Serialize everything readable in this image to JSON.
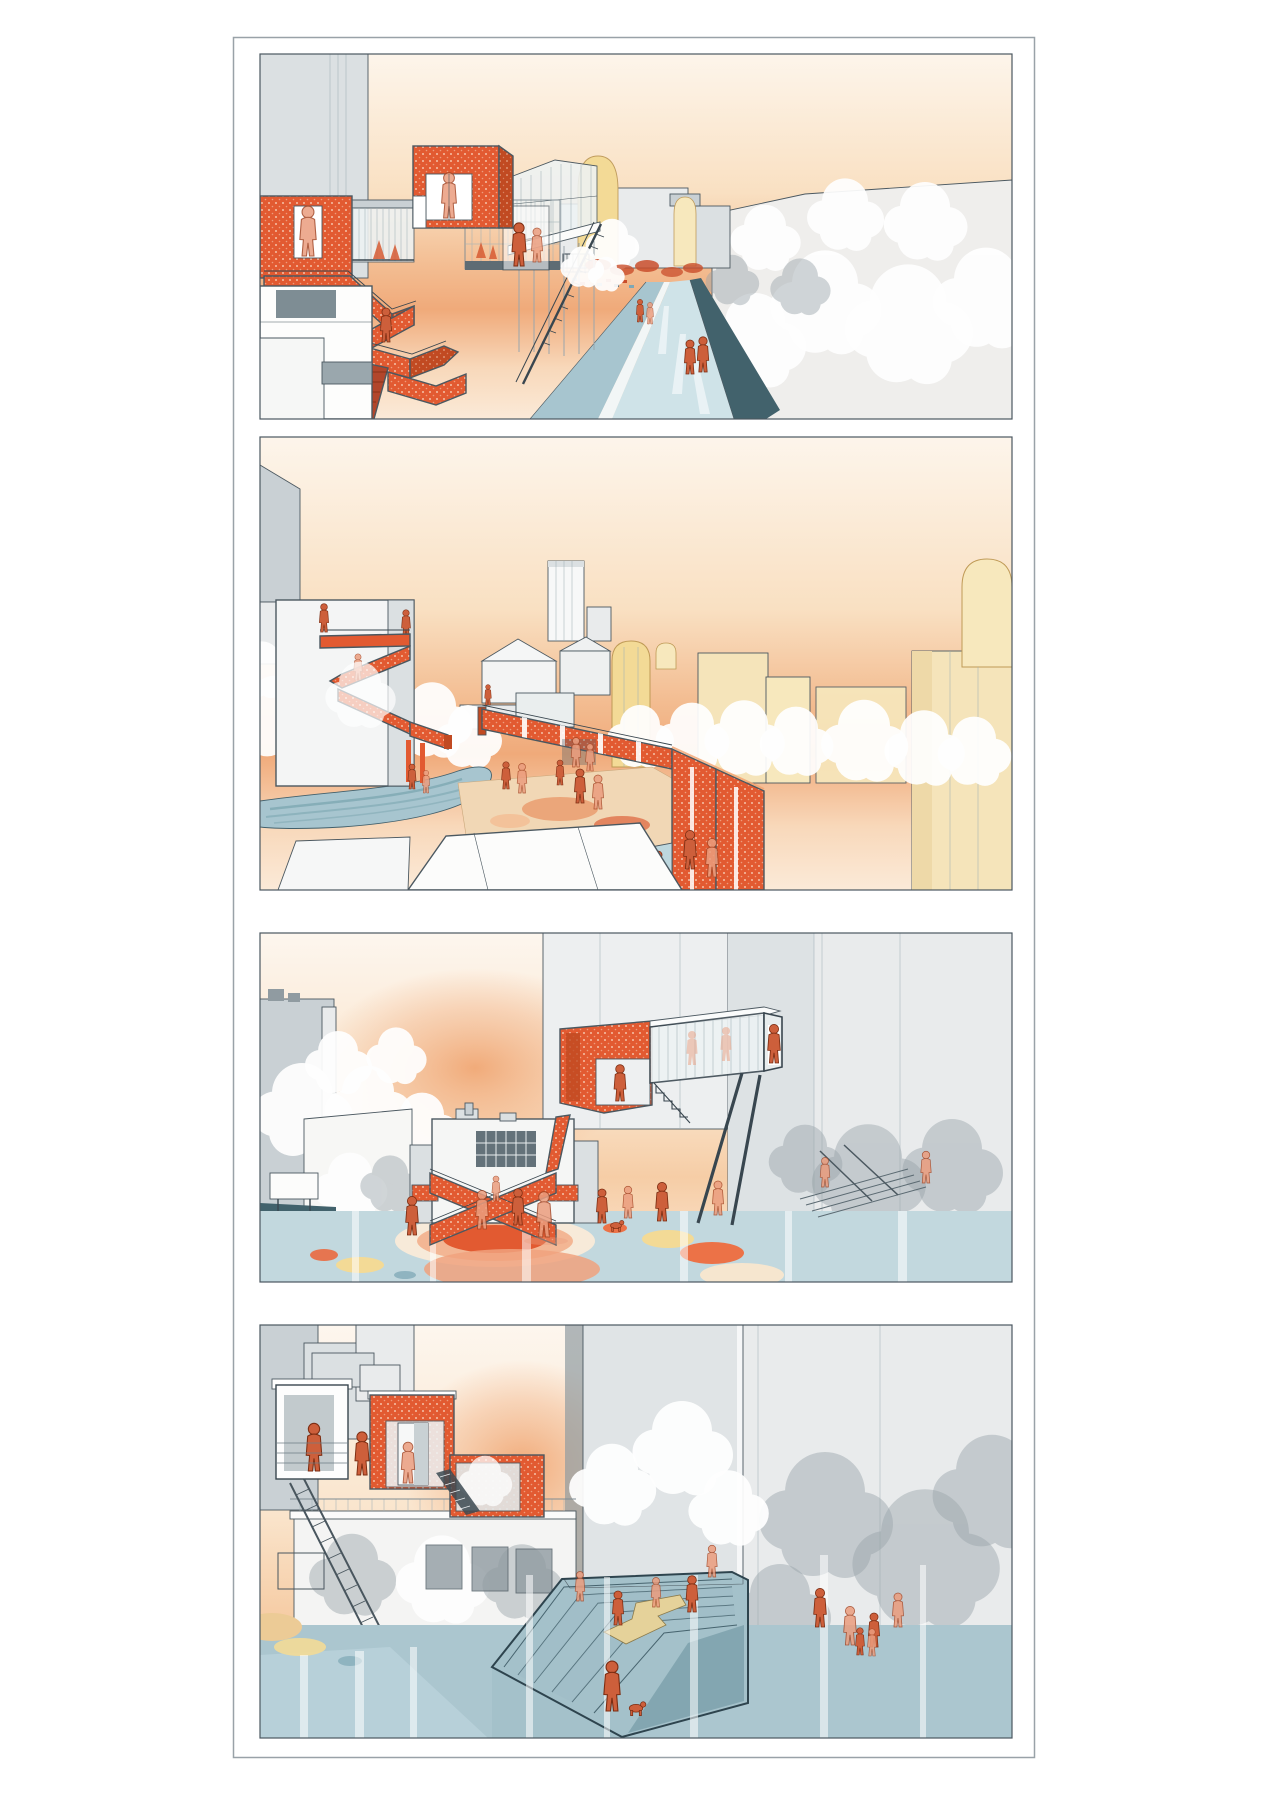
{
  "page": {
    "background": "#ffffff",
    "frame_border_color": "#99a2a8",
    "panel_border_color": "#4b5860"
  },
  "board": {
    "label": "Architectural concept board with four urban renderings",
    "panels": [
      {
        "id": "panel-1",
        "label": "Rendering 1: orange dotted stair tower and aerial glass walkway above a canal street at sunset"
      },
      {
        "id": "panel-2",
        "label": "Rendering 2: switchback orange stair on a block and an orange viaduct wall crossing a plaza with domed yellow towers"
      },
      {
        "id": "panel-3",
        "label": "Rendering 3: crossing X-shaped orange stair bridge over a plaza of orange and yellow circles with a glass bridge at right"
      },
      {
        "id": "panel-4",
        "label": "Rendering 4: rooftop orange pavilions and steel stair above a sunken terraced amphitheatre with water"
      }
    ]
  },
  "palette": {
    "orange": "#e25a31",
    "orange_deep": "#c14a22",
    "figure": "#cd5f3b",
    "salmon": "#eb9d7e",
    "sky_top": "#fdf5eb",
    "sky_mid": "#f9e0c2",
    "sky_deep": "#f0aa7a",
    "sky_haze": "#fbead8",
    "yellow": "#f3da96",
    "yellow_pale": "#f7e8bd",
    "cream": "#f5e4ba",
    "canal": "#cfe3e8",
    "walk": "#a7c5cf",
    "water": "#b7d0d9",
    "teal": "#42626c",
    "step_blue": "#9dbcc6",
    "gray_1": "#e9ebec",
    "gray_2": "#dbe0e2",
    "gray_3": "#c9d0d4",
    "gray_4": "#909ba1",
    "line": "#4b5860",
    "sand": "#e5d29a",
    "tan": "#f1d7b5"
  }
}
